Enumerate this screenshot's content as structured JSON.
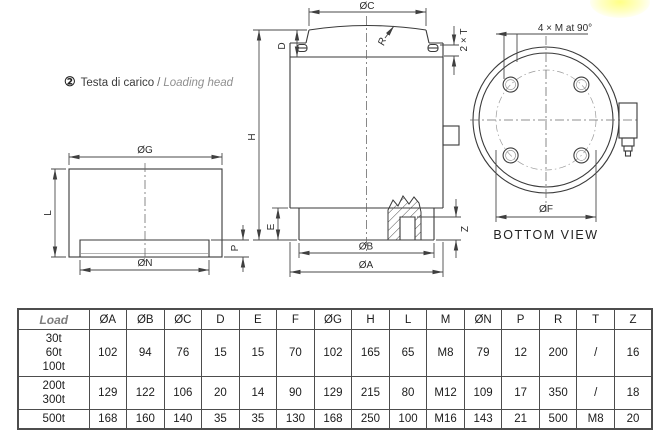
{
  "annotation": {
    "marker": "②",
    "title_it": "Testa di carico",
    "sep": "/",
    "title_en": "Loading head"
  },
  "drawings": {
    "section_view": {
      "og": "ØG",
      "l": "L",
      "p": "P",
      "on": "ØN"
    },
    "side_view": {
      "oc": "ØC",
      "d": "D",
      "two_t": "2 × T",
      "r": "R",
      "h": "H",
      "e": "E",
      "ob": "ØB",
      "oa": "ØA",
      "z": "Z"
    },
    "bottom_view": {
      "holes": "4 × M at 90°",
      "of": "ØF",
      "caption": "BOTTOM VIEW"
    }
  },
  "table": {
    "columns": [
      "Load",
      "ØA",
      "ØB",
      "ØC",
      "D",
      "E",
      "F",
      "ØG",
      "H",
      "L",
      "M",
      "ØN",
      "P",
      "R",
      "T",
      "Z"
    ],
    "rows": [
      {
        "load": [
          "30t",
          "60t",
          "100t"
        ],
        "values": [
          "102",
          "94",
          "76",
          "15",
          "15",
          "70",
          "102",
          "165",
          "65",
          "M8",
          "79",
          "12",
          "200",
          "/",
          "16"
        ]
      },
      {
        "load": [
          "200t",
          "300t"
        ],
        "values": [
          "129",
          "122",
          "106",
          "20",
          "14",
          "90",
          "129",
          "215",
          "80",
          "M12",
          "109",
          "17",
          "350",
          "/",
          "18"
        ]
      },
      {
        "load": [
          "500t"
        ],
        "values": [
          "168",
          "160",
          "140",
          "35",
          "35",
          "130",
          "168",
          "250",
          "100",
          "M16",
          "143",
          "21",
          "500",
          "M8",
          "20"
        ]
      }
    ]
  },
  "colors": {
    "line": "#3a3a3a",
    "dimension": "#4a4a4a",
    "highlight": "#ffff85",
    "table_border": "#4d4d4d"
  }
}
